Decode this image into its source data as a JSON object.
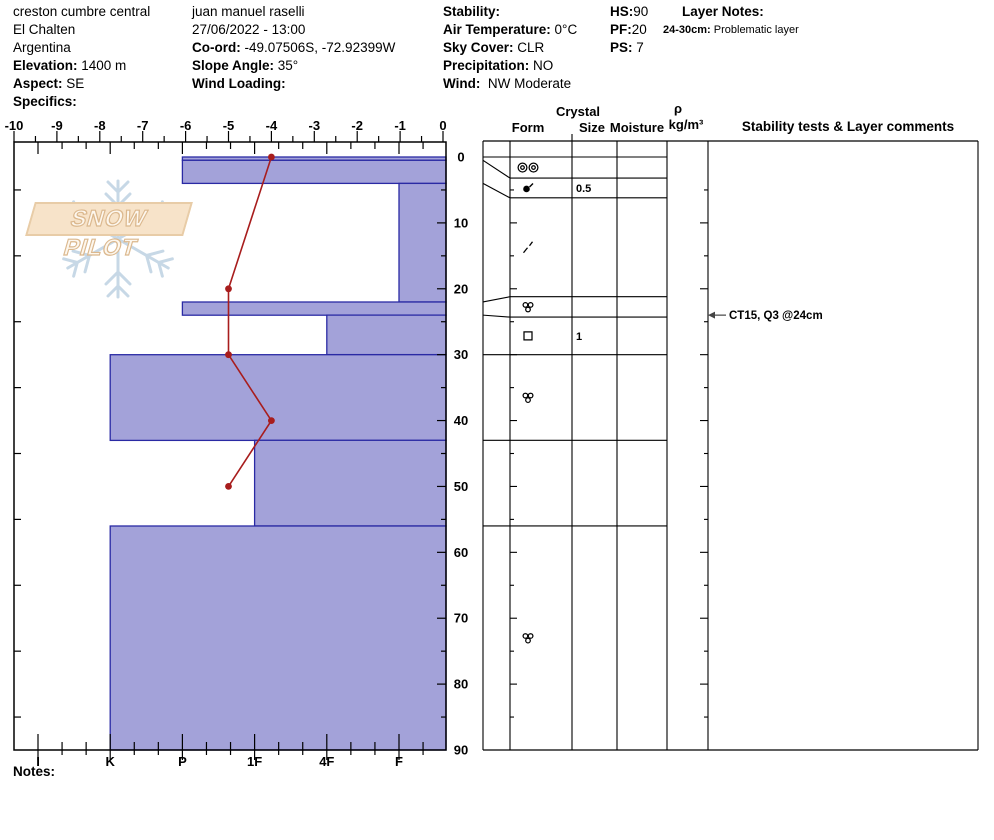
{
  "report": {
    "site": {
      "name": "creston cumbre central",
      "area": "El Chalten",
      "country": "Argentina",
      "elevation_label": "Elevation:",
      "elevation_value": " 1400 m",
      "aspect_label": "Aspect:",
      "aspect_value": " SE",
      "specifics_label": "Specifics:",
      "specifics_value": ""
    },
    "observation": {
      "observer": "juan manuel raselli",
      "datetime": "27/06/2022 - 13:00",
      "coord_label": "Co-ord:",
      "coord_value": " -49.07506S, -72.92399W",
      "slope_label": "Slope Angle:",
      "slope_value": " 35°",
      "wind_loading_label": "Wind Loading:",
      "wind_loading_value": ""
    },
    "conditions": {
      "stability_label": "Stability:",
      "stability_value": "",
      "air_temp_label": "Air Temperature:",
      "air_temp_value": " 0°C",
      "sky_label": "Sky Cover:",
      "sky_value": " CLR",
      "precip_label": "Precipitation:",
      "precip_value": " NO",
      "wind_label": "Wind:",
      "wind_value": "  NW Moderate"
    },
    "totals": {
      "hs_label": "HS:",
      "hs_value": "90",
      "pf_label": "PF:",
      "pf_value": "20",
      "ps_label": "PS:",
      "ps_value": " 7"
    },
    "layer_notes": {
      "title": "Layer Notes:",
      "entries": [
        {
          "range_label": "24-30cm:",
          "text": " Problematic layer"
        }
      ]
    },
    "notes_label": "Notes:"
  },
  "logo": {
    "text": "SNOW PILOT"
  },
  "panel": {
    "crystal_header": "Crystal",
    "form_header": "Form",
    "size_header": "Size",
    "moisture_header": "Moisture",
    "rho_header": "ρ",
    "rho_units": "kg/m³",
    "comments_header": "Stability tests & Layer comments"
  },
  "chart_data": {
    "type": "snow-profile",
    "title": "Snow pit hardness / temperature profile",
    "temperature_axis": {
      "unit": "°C",
      "min": -10,
      "max": 0,
      "major_step": 1,
      "minor_step": 0.5,
      "labels": [
        "-10",
        "-9",
        "-8",
        "-7",
        "-6",
        "-5",
        "-4",
        "-3",
        "-2",
        "-1",
        "0"
      ]
    },
    "hardness_axis": {
      "labels": [
        "I",
        "K",
        "P",
        "1F",
        "4F",
        "F"
      ]
    },
    "depth_axis": {
      "unit": "cm",
      "min": 0,
      "max": 90,
      "major_step": 10,
      "labels": [
        "0",
        "10",
        "20",
        "30",
        "40",
        "50",
        "60",
        "70",
        "80",
        "90"
      ]
    },
    "temperature_profile": [
      {
        "depth": 0,
        "temp": -4
      },
      {
        "depth": 20,
        "temp": -5
      },
      {
        "depth": 30,
        "temp": -5
      },
      {
        "depth": 40,
        "temp": -4
      },
      {
        "depth": 50,
        "temp": -5
      }
    ],
    "layers": [
      {
        "top": 0,
        "bottom": 0.5,
        "hardness": "P",
        "form": "double-circles",
        "size": "",
        "moisture": "",
        "density": "",
        "display_top": 0,
        "display_bottom": 3.2
      },
      {
        "top": 0.5,
        "bottom": 4,
        "hardness": "P",
        "form": "dot-slash",
        "size": "0.5",
        "moisture": "",
        "density": "",
        "display_top": 3.2,
        "display_bottom": 6.2
      },
      {
        "top": 4,
        "bottom": 22,
        "hardness": "F",
        "form": "slashes",
        "size": "",
        "moisture": "",
        "density": "",
        "display_top": 6.2,
        "display_bottom": 21.2
      },
      {
        "top": 22,
        "bottom": 24,
        "hardness": "P",
        "form": "three-circles",
        "size": "",
        "moisture": "",
        "density": "",
        "display_top": 21.2,
        "display_bottom": 24.3
      },
      {
        "top": 24,
        "bottom": 30,
        "hardness": "4F",
        "form": "square",
        "size": "1",
        "moisture": "",
        "density": "",
        "display_top": 24.3,
        "display_bottom": 30
      },
      {
        "top": 30,
        "bottom": 43,
        "hardness": "K",
        "form": "three-circles",
        "size": "",
        "moisture": "",
        "density": "",
        "display_top": 30,
        "display_bottom": 43
      },
      {
        "top": 43,
        "bottom": 56,
        "hardness": "1F",
        "form": "",
        "size": "",
        "moisture": "",
        "density": "",
        "display_top": 43,
        "display_bottom": 56
      },
      {
        "top": 56,
        "bottom": 90,
        "hardness": "K",
        "form": "three-circles",
        "size": "",
        "moisture": "",
        "density": "",
        "display_top": 56,
        "display_bottom": 90
      }
    ],
    "stability_tests": [
      {
        "text": "CT15, Q3 @24cm",
        "depth": 24
      }
    ],
    "colors": {
      "bar_fill": "#a3a2d9",
      "bar_border": "#2a2aa4",
      "temp_line": "#a81d1d",
      "flake": "#c7d8e6"
    }
  }
}
